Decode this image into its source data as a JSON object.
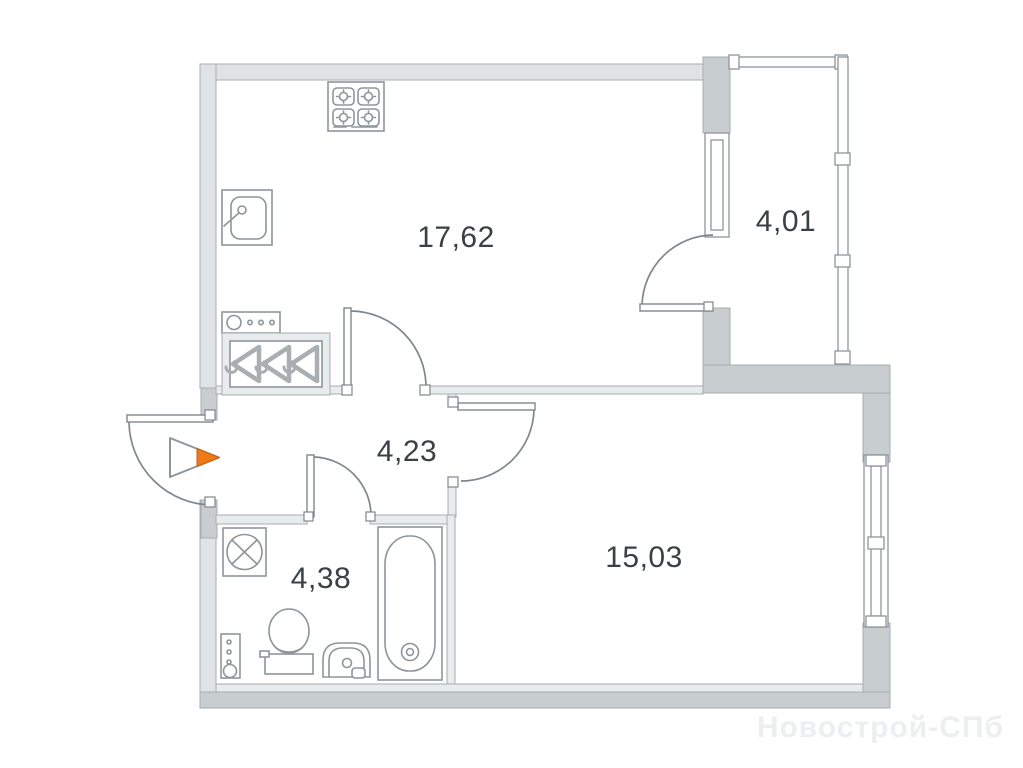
{
  "plan": {
    "watermark": "Новострой-СПб",
    "rooms": [
      {
        "name": "kitchen-living-room",
        "area_label": "17,62"
      },
      {
        "name": "balcony",
        "area_label": "4,01"
      },
      {
        "name": "hallway",
        "area_label": "4,23"
      },
      {
        "name": "bedroom",
        "area_label": "15,03"
      },
      {
        "name": "bathroom",
        "area_label": "4,38"
      }
    ]
  },
  "theme": {
    "wall_light": "#dfe3e5",
    "wall_inner": "#e9eced",
    "wall_dark": "#c8cdd0",
    "outline": "#a6adb2",
    "line": "#7f878d",
    "furniture_line": "#8d959b",
    "hanger_line": "#a9aeb3",
    "label_color": "#3a4046",
    "accent": "#ee7a17",
    "accent_dark": "#c95f10",
    "watermark_color": "#eceeef"
  }
}
